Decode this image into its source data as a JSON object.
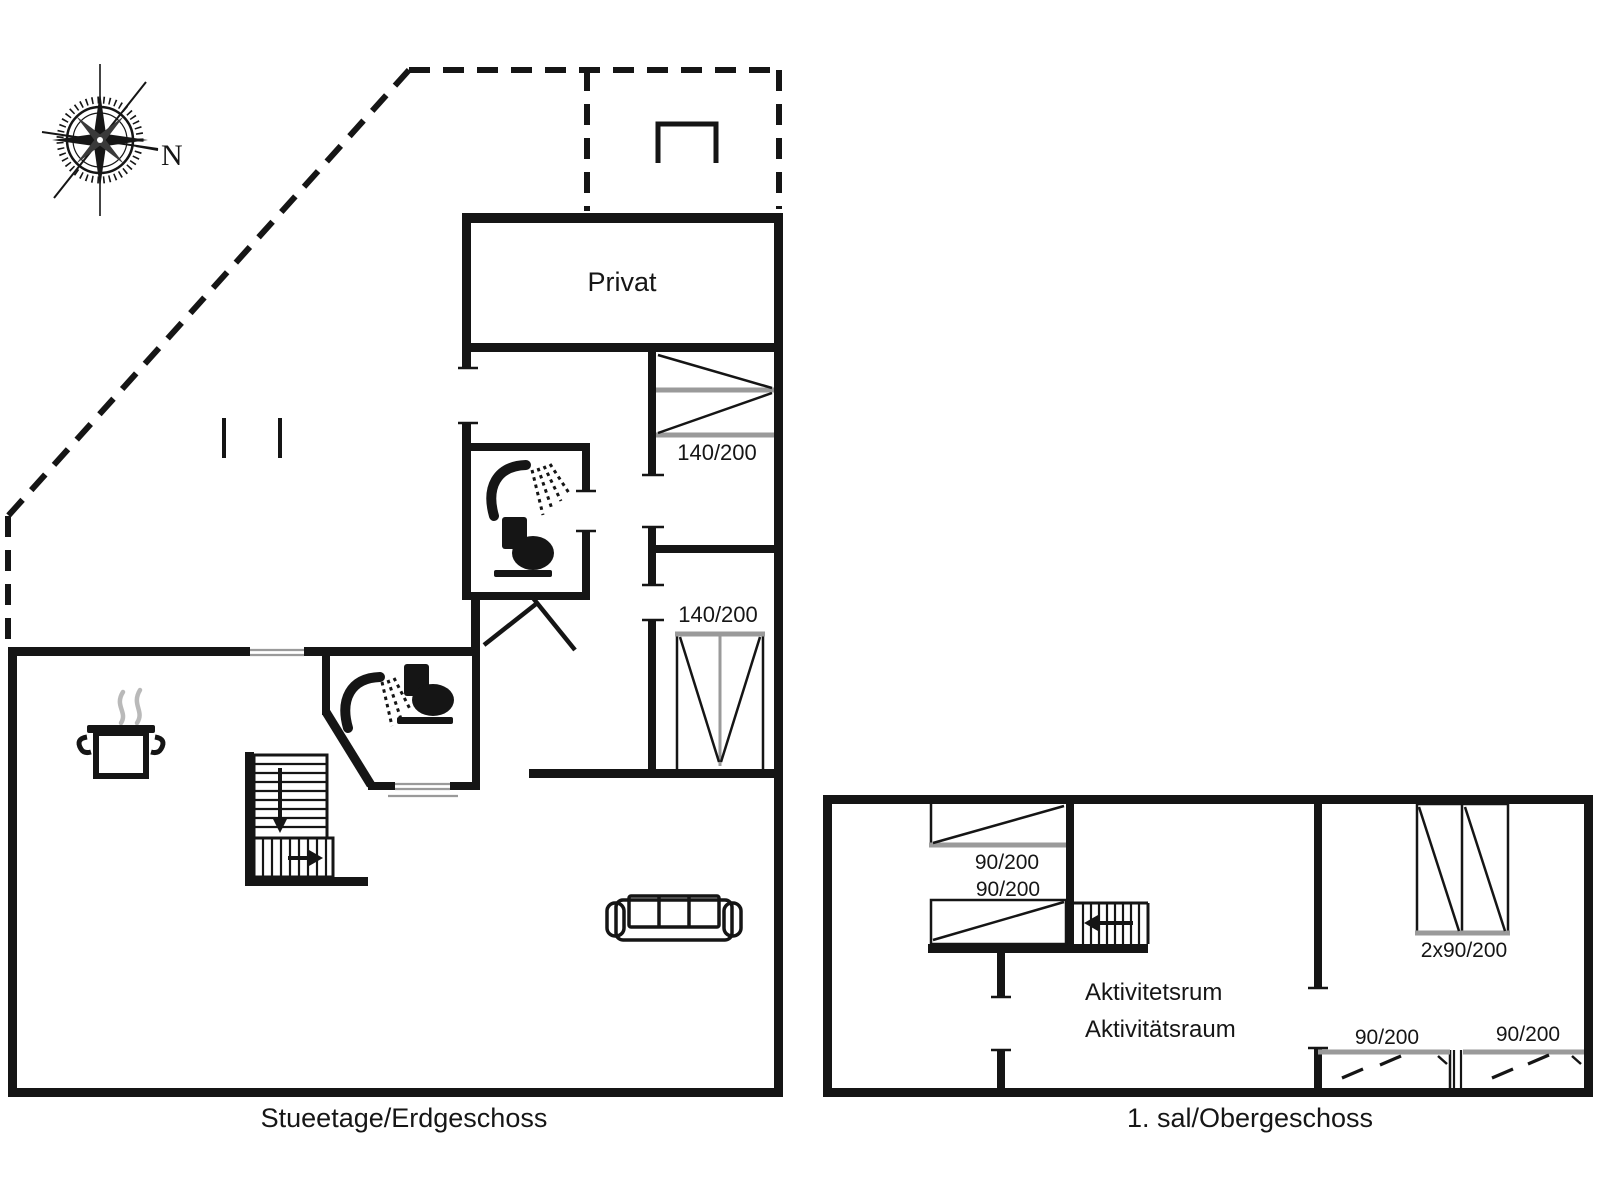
{
  "compass": {
    "label": "N"
  },
  "ground_floor": {
    "caption": "Stueetage/Erdgeschoss",
    "private_room_label": "Privat",
    "bed_labels": [
      "140/200",
      "140/200"
    ]
  },
  "upper_floor": {
    "caption": "1. sal/Obergeschoss",
    "activity_room_label_da": "Aktivitetsrum",
    "activity_room_label_de": "Aktivitätsraum",
    "single_bed_labels": [
      "90/200",
      "90/200"
    ],
    "double_bed_label": "2x90/200",
    "attic_bed_labels": [
      "90/200",
      "90/200"
    ]
  }
}
